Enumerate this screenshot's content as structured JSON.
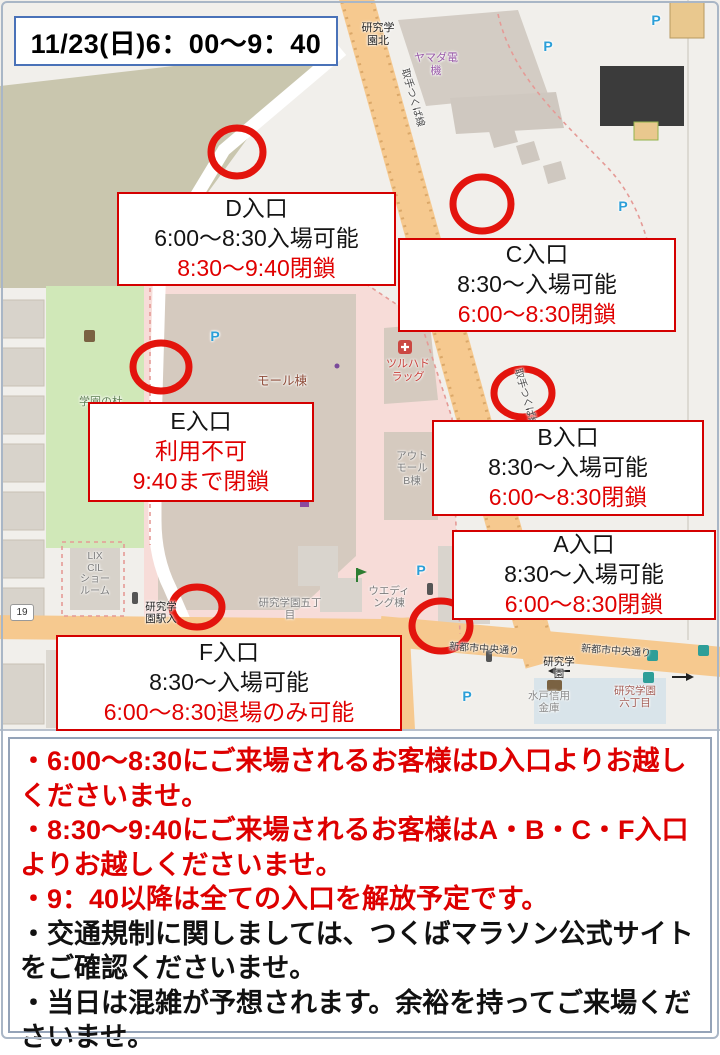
{
  "title": "11/23(日)6：00～9：40",
  "entrances": {
    "d": {
      "name": "D入口",
      "line2": "6:00～8:30入場可能",
      "line3": "8:30～9:40閉鎖"
    },
    "c": {
      "name": "C入口",
      "line2": "8:30～入場可能",
      "line3": "6:00～8:30閉鎖"
    },
    "e": {
      "name": "E入口",
      "line2": "利用不可",
      "line3": "9:40まで閉鎖"
    },
    "b": {
      "name": "B入口",
      "line2": "8:30～入場可能",
      "line3": "6:00～8:30閉鎖"
    },
    "a": {
      "name": "A入口",
      "line2": "8:30～入場可能",
      "line3": "6:00～8:30閉鎖"
    },
    "f": {
      "name": "F入口",
      "line2": "8:30～入場可能",
      "line3": "6:00～8:30退場のみ可能"
    }
  },
  "notes": [
    {
      "text": "・6:00～8:30にご来場されるお客様はD入口よりお越しくださいませ。",
      "color": "red"
    },
    {
      "text": "・8:30～9:40にご来場されるお客様はA・B・C・F入口よりお越しくださいませ。",
      "color": "red"
    },
    {
      "text": "・9：40以降は全ての入口を解放予定です。",
      "color": "red"
    },
    {
      "text": "・交通規制に関しましては、つくばマラソン公式サイトをご確認くださいませ。",
      "color": "black"
    },
    {
      "text": "・当日は混雑が予想されます。余裕を持ってご来場くださいませ。",
      "color": "black"
    }
  ],
  "map": {
    "labels": {
      "kenkyu_gakuen_kita": "研究学\n園北",
      "yamada_denki": "ヤマダ電\n機",
      "toride_tsukuba_line": "取手つくば線",
      "gakuen_no_mori_park": "学園の杜\n公園",
      "mall_building": "モール棟",
      "tsuruha_drug": "ツルハド\nラッグ",
      "outlet_mall_b": "アウト\nモール\nB棟",
      "wedding_building": "ウエディ\nング棟",
      "gakuen_5chome": "研究学園五丁\n目",
      "lixil_showroom": "LIX\nCIL\nショー\nルーム",
      "route_19": "19",
      "gakuen_eki_iri": "研究学\n園駅入",
      "shintoshi_chuo_dori": "新都市中央通り",
      "kenkyu_gakuen": "研究学\n園",
      "mito_shinkin_bank": "水戸信用\n金庫",
      "gakuen_6chome": "研究学園\n六丁目",
      "parking": "P"
    },
    "colors": {
      "road_orange": "#f6c98f",
      "park_green": "#d0e8b8",
      "pedestrian_pink": "#f7dcd8",
      "marker_red": "#e3140d",
      "accent_red": "#e00000"
    }
  }
}
